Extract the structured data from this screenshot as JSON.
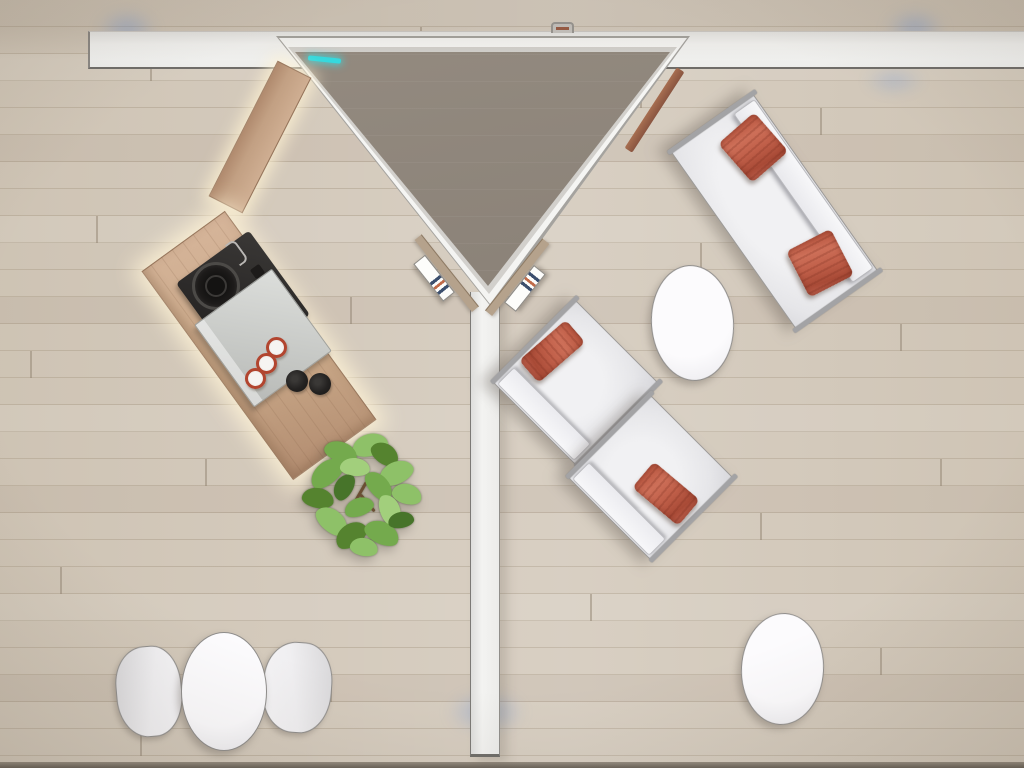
{
  "scene": {
    "title": "Top-down 3D rendering of a modular lounge / exhibition space",
    "view": "overhead plan view, no visible text or UI controls",
    "objects": [
      {
        "name": "top-wall",
        "desc": "long white partition wall across the top"
      },
      {
        "name": "wall-bracket",
        "desc": "small mounting clamp on top wall"
      },
      {
        "name": "triangle-pod",
        "desc": "triangular canopy room with white frame and taupe roof"
      },
      {
        "name": "cyan-light-strip",
        "desc": "small cyan LED strip on canopy edge"
      },
      {
        "name": "wood-trim",
        "desc": "wooden trim along right canopy edge"
      },
      {
        "name": "brochure-shelf-left",
        "desc": "wall shelf with brochure, left of apex"
      },
      {
        "name": "brochure-shelf-right",
        "desc": "wall shelf with brochure, right of apex"
      },
      {
        "name": "center-wall",
        "desc": "vertical white partition from apex to bottom"
      },
      {
        "name": "coffee-bar",
        "desc": "diagonal wooden bar connecting wall to counter"
      },
      {
        "name": "coffee-counter",
        "desc": "wooden island counter with LED glow"
      },
      {
        "name": "coffee-machine",
        "desc": "black coffee machine with round burner"
      },
      {
        "name": "counter-tray",
        "desc": "light gray tray on counter"
      },
      {
        "name": "espresso-cups",
        "desc": "three white cups with red rims"
      },
      {
        "name": "black-bowls",
        "desc": "two small black bowls"
      },
      {
        "name": "potted-plant",
        "desc": "green leafy plant at counter end"
      },
      {
        "name": "sofa",
        "desc": "white two-seat sofa with two terracotta pillows, rotated"
      },
      {
        "name": "armchair-1",
        "desc": "white lounge chair with terracotta pillow"
      },
      {
        "name": "armchair-2",
        "desc": "white lounge chair with terracotta pillow"
      },
      {
        "name": "oval-table-center",
        "desc": "white oval coffee table near armchairs"
      },
      {
        "name": "oval-table-bottom-right",
        "desc": "white oval table, lower right"
      },
      {
        "name": "round-table-bottom-left",
        "desc": "white table flanked by two shell chairs"
      },
      {
        "name": "shell-chair-left",
        "desc": "white shell chair"
      },
      {
        "name": "shell-chair-right",
        "desc": "white shell chair"
      },
      {
        "name": "blue-floor-glows",
        "desc": "soft blue light reflections on floor"
      }
    ]
  },
  "palette": {
    "floor": "#d4cabc",
    "floor-line": "#bfb3a2",
    "wall": "#f3f3f1",
    "roof": "#8a8177",
    "shelf-wood": "#b5a28c",
    "counter-wood": "#c9a888",
    "appliance": "#2b2928",
    "cup-rim": "#b2452f",
    "cushion": "#e6e6e9",
    "pillow": "#c05f49",
    "table": "#f2f1f4",
    "outline": "#8f8d8b",
    "accent-cyan": "#35d9de",
    "plant-green": "#74aa4d",
    "led-glow": "#fff3d6"
  }
}
